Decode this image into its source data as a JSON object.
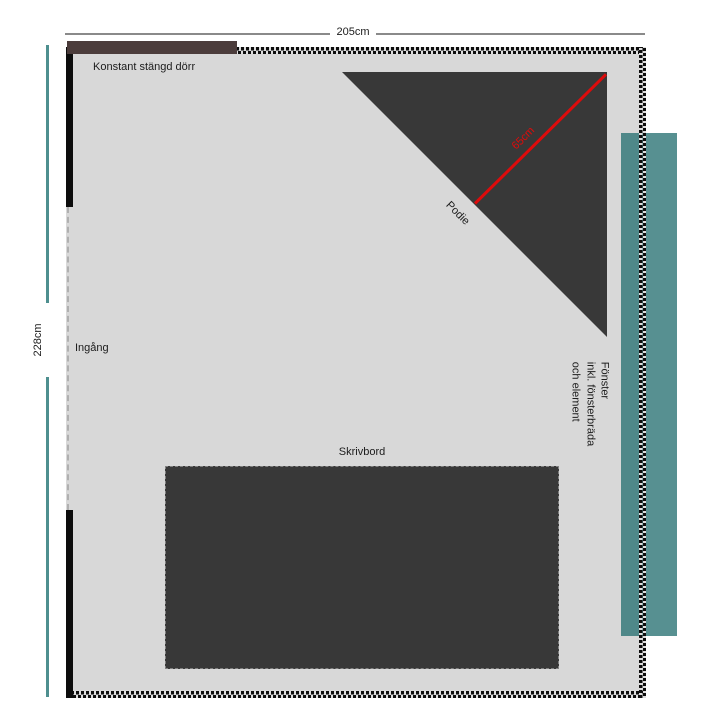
{
  "diagram": {
    "type": "floor-plan",
    "room": {
      "width_label": "205cm",
      "height_label": "228cm"
    },
    "door": {
      "label": "Konstant stängd dörr"
    },
    "entrance": {
      "label": "Ingång"
    },
    "podie": {
      "label": "Podie",
      "depth_label": "65cm"
    },
    "window": {
      "lines": [
        "Fönster",
        "inkl. fönsterbräda",
        "och element"
      ]
    },
    "desk": {
      "label": "Skrivbord"
    },
    "colors": {
      "room_fill": "#d8d8d8",
      "wall": "#0d0d0d",
      "dark_furniture": "#383838",
      "door_brown": "#4b3c3b",
      "window_teal": "#579091",
      "height_dim_line_teal": "#4e8f8f",
      "width_dim_line_gray": "#8a8a8a",
      "measure_red": "#de0b0b"
    }
  }
}
